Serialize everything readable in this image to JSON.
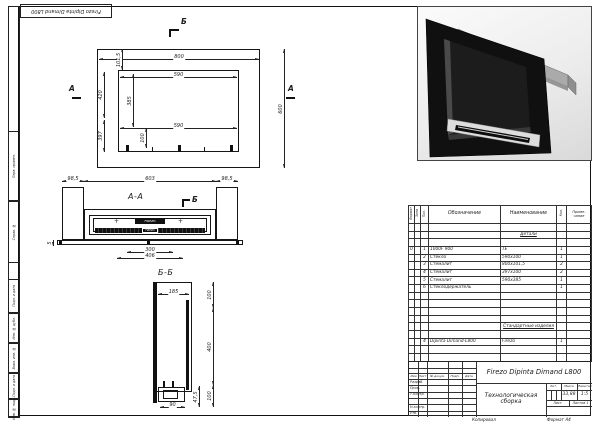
{
  "stamp": {
    "title": "Firezo Dipinta Dimand L800"
  },
  "margins": [
    "Перв. примен.",
    "Справ. №",
    "Подп. и дата",
    "Инв. № дубл.",
    "Взам. инв. №",
    "Подп. и дата",
    "Инв. № подл."
  ],
  "front": {
    "mark_b": "Б",
    "mark_a": "А",
    "dim_width": "800",
    "dim_top_band": "101,5",
    "dim_opening_top": "590",
    "dim_opening_bottom": "590",
    "dim_height": "600",
    "dim_left_upper": "420",
    "dim_left_lower": "397",
    "dim_opening_height": "385",
    "dim_bottom_strip": "100"
  },
  "section_aa": {
    "label": "А-А",
    "mark_b": "Б",
    "dim_left": "98,5",
    "dim_mid": "603",
    "dim_right": "98,5",
    "dim_300": "300",
    "dim_406": "406",
    "dim_5": "5",
    "burner_brand": "FIREZO"
  },
  "section_bb": {
    "label": "Б-Б",
    "dim_185": "185",
    "dim_100_top": "100",
    "dim_400": "400",
    "dim_100_bottom": "100",
    "dim_90": "90",
    "dim_47_5": "47,5"
  },
  "parts_table": {
    "headers": {
      "format": "Формат",
      "zone": "Зона",
      "pos": "Поз.",
      "designation": "Обозначение",
      "name": "Наименование",
      "qty": "Кол.",
      "note1": "Приме-",
      "note2": "чание"
    },
    "sections": {
      "details": "Детали",
      "standard": "Стандартные изделия"
    },
    "rows": [
      {
        "format": "0",
        "pos": "1",
        "designation": "1000F 900",
        "name": "ТЕ",
        "qty": "1"
      },
      {
        "format": "",
        "pos": "2",
        "designation": "Стекло",
        "name": "590х100",
        "qty": "1"
      },
      {
        "format": "",
        "pos": "3",
        "designation": "Стемалит",
        "name": "800х101,5",
        "qty": "2"
      },
      {
        "format": "",
        "pos": "4",
        "designation": "Стемалит",
        "name": "397х100",
        "qty": "2"
      },
      {
        "format": "",
        "pos": "5",
        "designation": "Стемалит",
        "name": "590х385",
        "qty": "1"
      },
      {
        "format": "",
        "pos": "6",
        "designation": "Стеклодержатель",
        "name": "",
        "qty": "1"
      }
    ],
    "standard_rows": [
      {
        "pos": "4",
        "designation": "Dipinta Dimand-L800",
        "name": "Firezo",
        "qty": "1"
      }
    ]
  },
  "title_block": {
    "designation": "Firezo Dipinta Dimand L800",
    "doc_type_line1": "Технологическая",
    "doc_type_line2": "сборка",
    "lit_header": "Лит.",
    "mass_header": "Масса",
    "scale_header": "Масштаб",
    "mass": "33,88",
    "scale": "1:5",
    "sheet": "Лист",
    "sheets": "Листов 1",
    "sig_cols": [
      "Изм.",
      "Лист",
      "№ докум.",
      "Подп.",
      "Дата"
    ],
    "sig_rows": [
      "Разраб.",
      "Пров.",
      "Т.контр.",
      "",
      "Н.контр.",
      "Утв."
    ],
    "copied": "Копировал",
    "format": "Формат А4"
  },
  "colors": {
    "line": "#1c1c1c",
    "fire_black": "#111111",
    "metal_gray": "#a8a8a8"
  }
}
